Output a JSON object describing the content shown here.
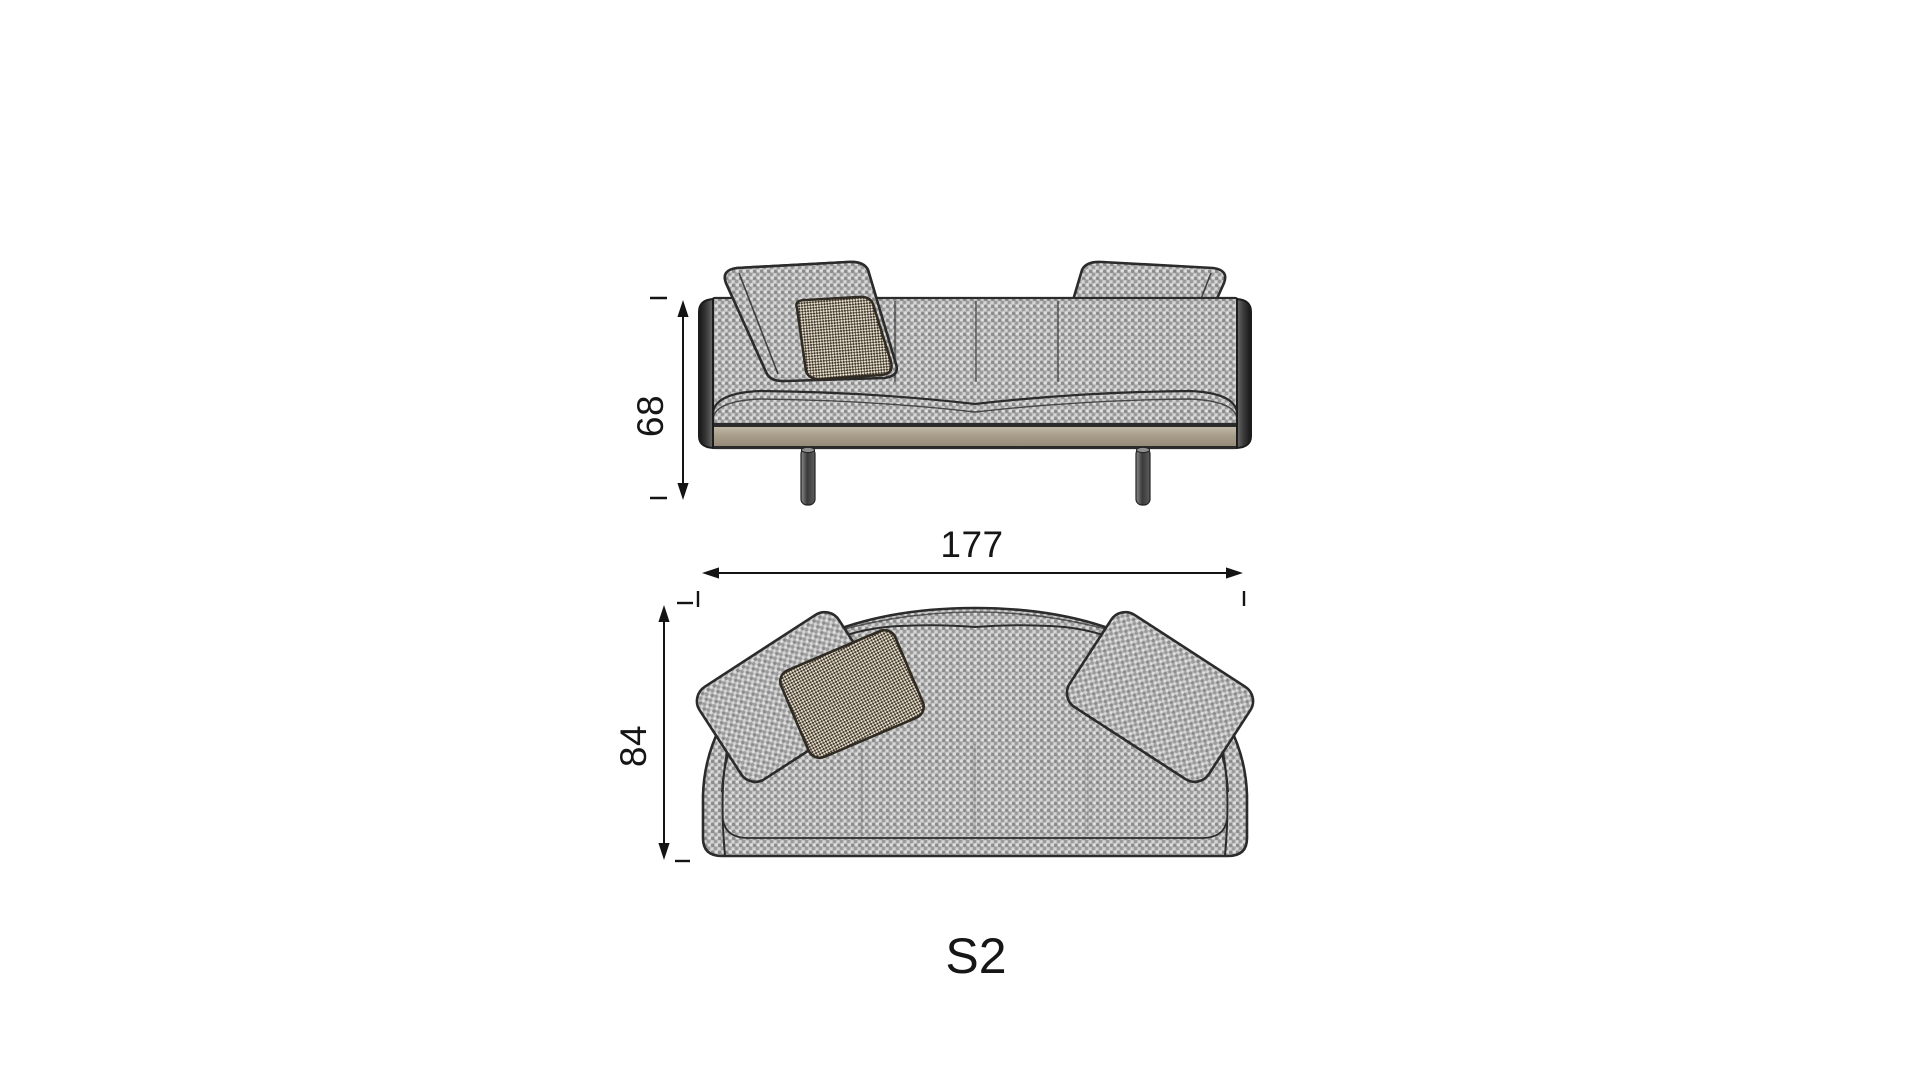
{
  "drawing": {
    "product_label": "S2",
    "dimensions": {
      "height": "68",
      "width": "177",
      "depth": "84"
    }
  },
  "colors": {
    "background": "#ffffff",
    "outline": "#2b2b2b",
    "fabric_gray": "#b9b9b9",
    "fabric_dark_fleck": "#8b8b8b",
    "fabric_light_fleck": "#e0e0e0",
    "base_rail_tan": "#a89e8b",
    "leg_metal": "#4a4a4a",
    "pillow_check_dark": "#433b30",
    "pillow_check_light": "#e6ddca",
    "dimension_ink": "#141414"
  }
}
